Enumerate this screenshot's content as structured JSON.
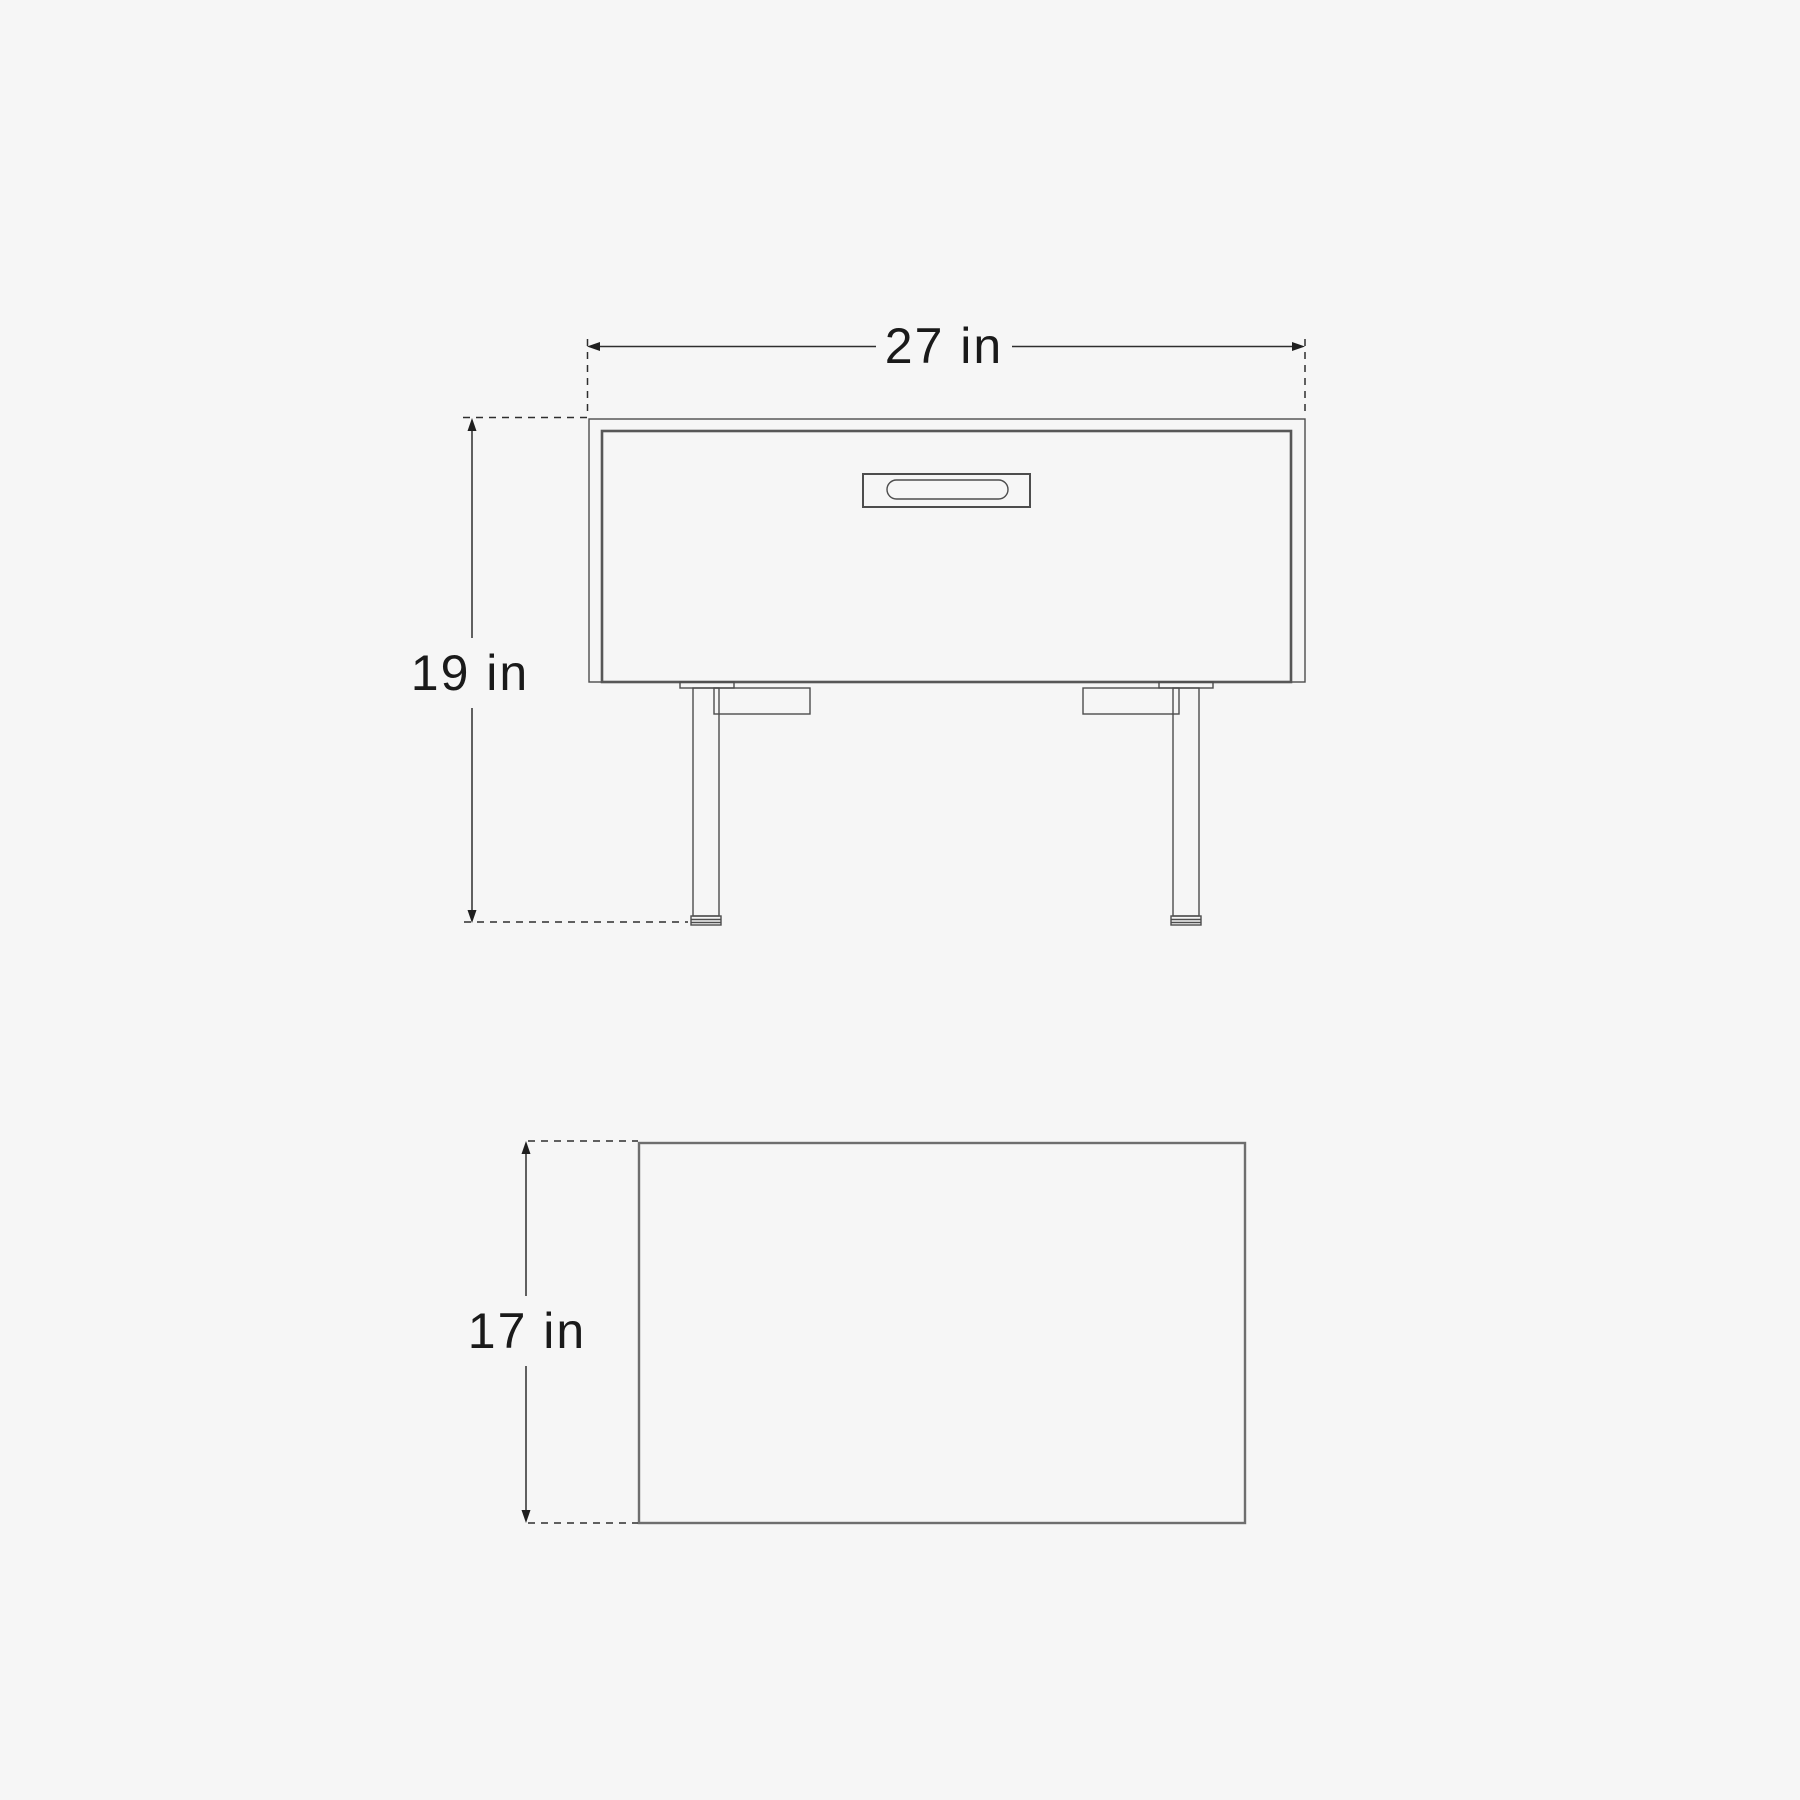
{
  "page": {
    "background_color": "#f6f6f6",
    "outline_color": "#4d4d4d",
    "dimension_line_color": "#2e2e2e",
    "text_color": "#1a1a1a"
  },
  "diagram": {
    "type": "furniture-dimension-drawing",
    "views": [
      "front-elevation",
      "top-plan"
    ],
    "dimensions": {
      "width": {
        "label": "27 in",
        "value": 27,
        "unit": "in"
      },
      "height": {
        "label": "19 in",
        "value": 19,
        "unit": "in"
      },
      "depth": {
        "label": "17 in",
        "value": 17,
        "unit": "in"
      }
    }
  }
}
